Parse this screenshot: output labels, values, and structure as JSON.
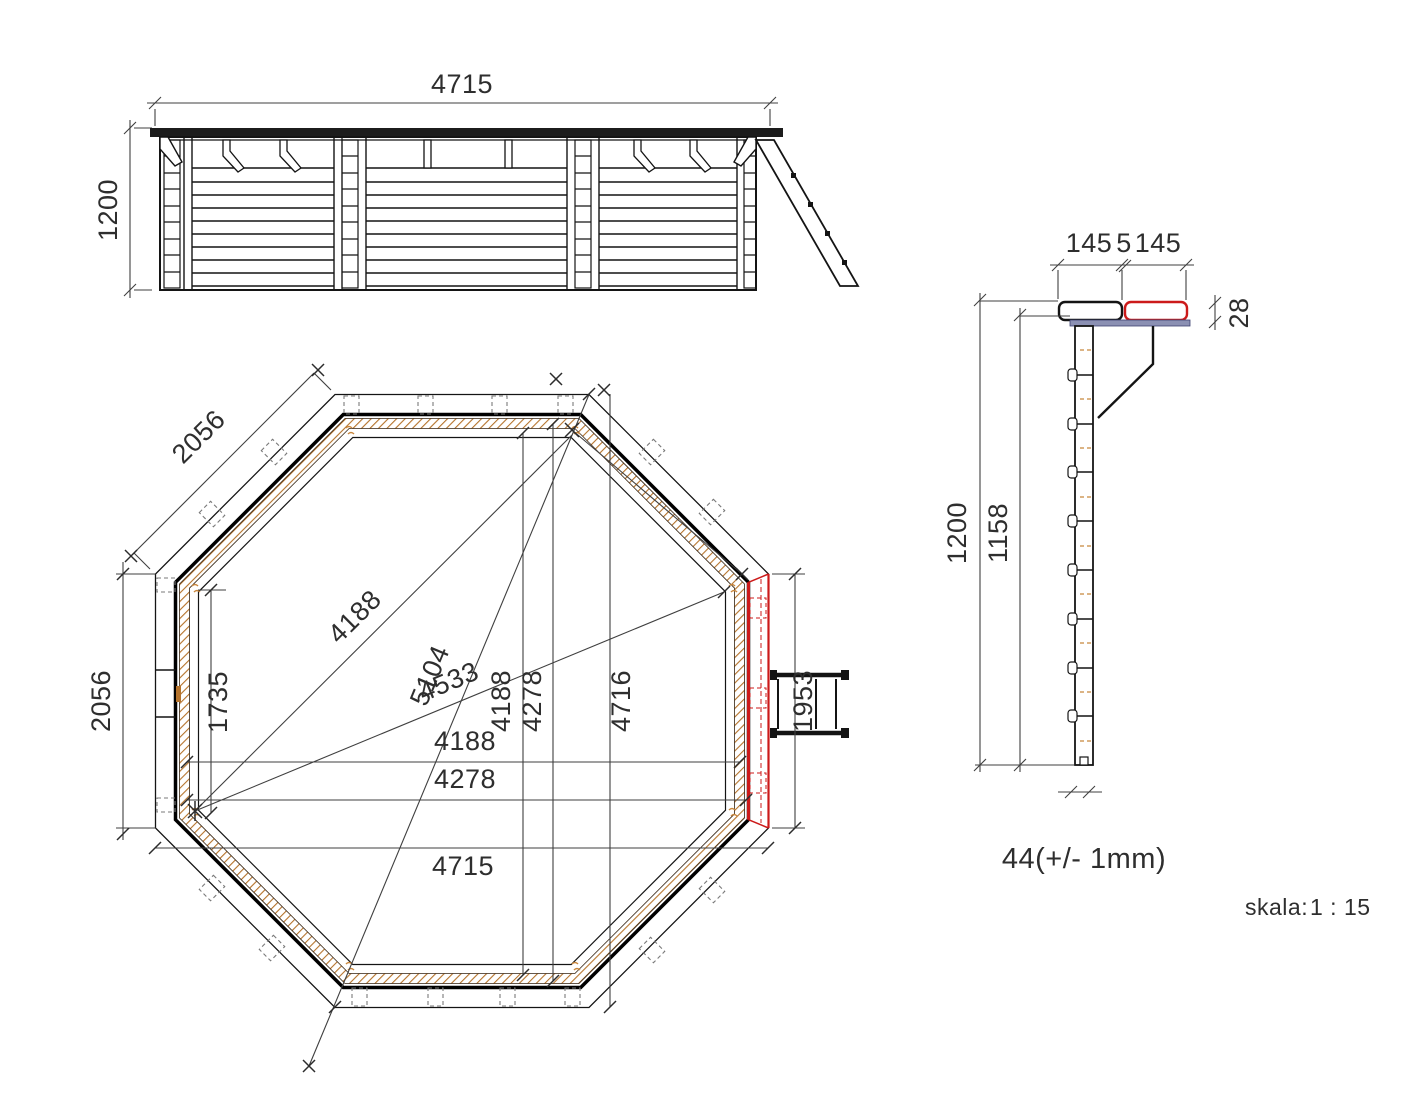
{
  "drawing": {
    "type": "technical-drawing",
    "subject": "octagonal wooden pool",
    "scale_label": "skala:",
    "scale_value": "1 : 15"
  },
  "colors": {
    "line_black": "#141414",
    "dim_gray": "#3f3f3f",
    "hatch_brown": "#b5732b",
    "accent_red": "#cc1a1a",
    "cap_strip_blue": "#8b90b3"
  },
  "elevation": {
    "width": "4715",
    "height": "1200"
  },
  "plan": {
    "side_diagonal": "2056",
    "side_left": "2056",
    "left_inner": "1735",
    "diag_inner": "4188",
    "diag_long": "5104",
    "diag_mid": "4533",
    "vert_inner_a": "4188",
    "vert_inner_b": "4278",
    "vert_outer": "4716",
    "horiz_inner_a": "4188",
    "horiz_inner_b": "4278",
    "horiz_outer": "4715",
    "ladder_panel": "1953"
  },
  "section": {
    "cap_left": "145",
    "cap_gap": "5",
    "cap_right": "145",
    "cap_thickness": "28",
    "height_total": "1200",
    "height_wall": "1158",
    "plank_thickness": "44(+/- 1mm)"
  }
}
